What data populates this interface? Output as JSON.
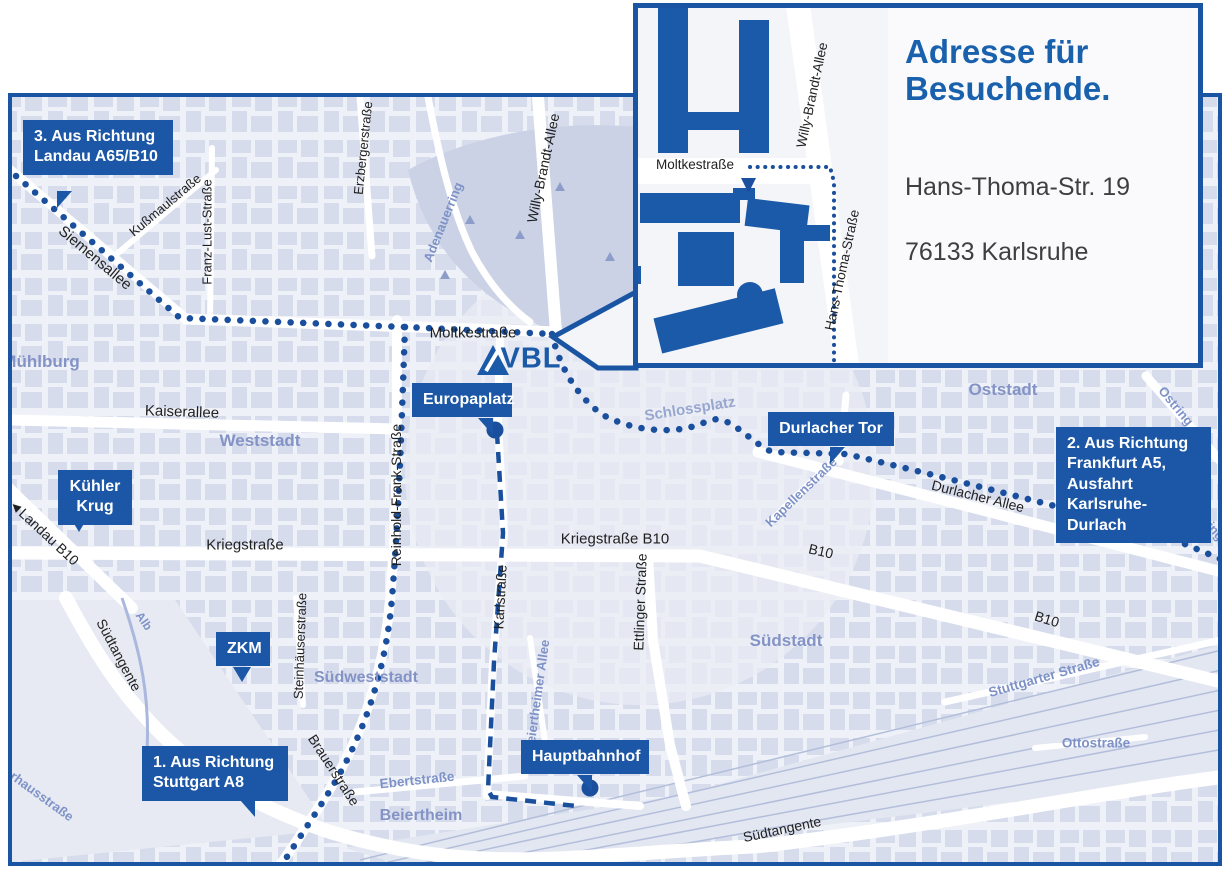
{
  "colors": {
    "brand_blue": "#1b57a6",
    "frame_blue": "#1a55a3",
    "route_blue": "#1a4f9e",
    "map_background": "#eef1f7",
    "block_fill": "#d6dcec",
    "area_label": "#8493c6",
    "street_label_black": "#1f1f1f",
    "street_label_blue": "#7e92c8",
    "title_blue": "#1961ad",
    "address_gray": "#3f3f3f"
  },
  "logo": {
    "text": "VBL"
  },
  "inset": {
    "title": "Adresse für\nBesuchende.",
    "address_line1": "Hans-Thoma-Str. 19",
    "address_line2": "76133 Karlsruhe",
    "street_moltkestrasse": "Moltkestraße",
    "street_willy_brandt_allee": "Willy-Brandt-Allee",
    "street_hans_thoma_strasse": "Hans-Thoma-Straße"
  },
  "callouts": {
    "route3": "3. Aus Richtung\nLandau A65/B10",
    "route2": "2. Aus Richtung\nFrankfurt A5,\nAusfahrt\nKarlsruhe-Durlach",
    "route1": "1. Aus Richtung\nStuttgart A8",
    "kuehler_krug": "Kühler\nKrug",
    "zkm": "ZKM",
    "europaplatz": "Europaplatz",
    "durlacher_tor": "Durlacher Tor",
    "hauptbahnhof": "Hauptbahnhof"
  },
  "streets": {
    "siemensallee": "Siemensallee",
    "kussmaulstrasse": "Kußmaulstraße",
    "franz_lust_strasse": "Franz-Lust-Straße",
    "erzbergerstrasse": "Erzbergerstraße",
    "willy_brandt_allee": "Willy-Brandt-Allee",
    "moltkestrasse": "Moltkestraße",
    "adenauerring": "Adenauerring",
    "kaiserallee": "Kaiserallee",
    "reinhold_frank_strasse": "Reinhold-Frank-Straße",
    "landau_b10": "◄Landau B10",
    "kriegstrasse": "Kriegstraße",
    "kriegstrasse_b10": "Kriegstraße B10",
    "karlstrasse": "Karlstraße",
    "ettlinger_strasse": "Ettlinger Straße",
    "durlacher_allee": "Durlacher Allee",
    "b10_east": "B10",
    "b10_south": "B10",
    "kapellenstrasse": "Kapellenstraße",
    "ostring_north": "Ostring",
    "ostring_south": "Ostring",
    "stuttgarter_strasse": "Stuttgarter Straße",
    "beiertheimer_allee": "Beiertheimer Allee",
    "ebertstrasse": "Ebertstraße",
    "steinhaeuserstrasse": "Steinhäuserstraße",
    "brauerstrasse": "Brauerstraße",
    "suedtangente_west": "Südtangente",
    "suedtangente_south": "Südtangente",
    "alb": "Alb",
    "pulverhausstrasse": "Pulverhausstraße",
    "ottostrasse": "Ottostraße"
  },
  "areas": {
    "muehlburg": "Mühlburg",
    "weststadt": "Weststadt",
    "oststadt": "Oststadt",
    "suedstadt": "Südstadt",
    "suedweststadt": "Südweststadt",
    "beiertheim": "Beiertheim",
    "schlossplatz": "Schlossplatz"
  }
}
